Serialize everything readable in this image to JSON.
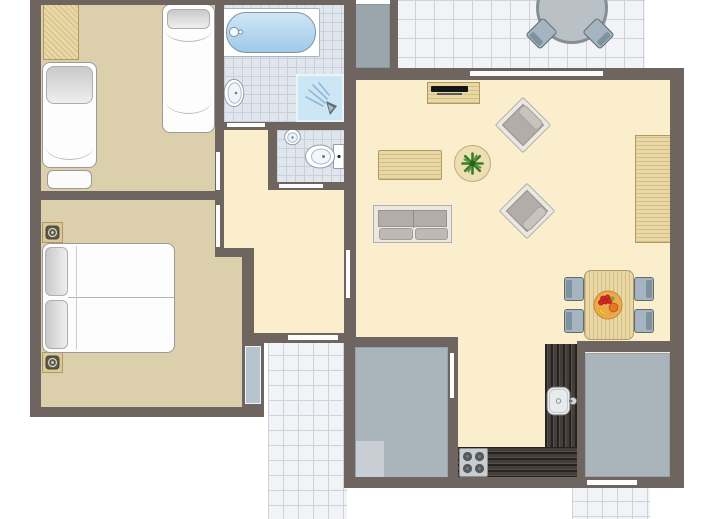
{
  "app": {
    "title": "apartment-floorplan",
    "canvas": {
      "width": 713,
      "height": 519,
      "background": "#ffffff"
    }
  },
  "palette": {
    "wall": "#6e6561",
    "door": "#fdfdfd",
    "floor_cream": "#faeecd",
    "floor_tan": "#dbd0ab",
    "bath_tile": "#e0e6ec",
    "bath_tile_line": "#c6d0dc",
    "path_tile": "#f1f3f6",
    "path_tile_line": "#ccd3db",
    "storage_gray": "#a9b4bb",
    "wood": "#e9d8a6",
    "wood_border": "#b09a62",
    "counter_dark": "#443e3b",
    "upholstery_gray": "#b3aca9",
    "chair_blue": "#a4b5c1",
    "water_blue": "#9fc9e9",
    "plant_green": "#3e7b2b"
  },
  "elements": [
    {
      "name": "terrace-floor",
      "type": "tiles",
      "x": 396,
      "y": 0,
      "w": 249,
      "h": 70,
      "bg": "#f1f3f6",
      "line": "#ccd3db",
      "size": 19
    },
    {
      "name": "entrance-path",
      "type": "tiles",
      "x": 268,
      "y": 340,
      "w": 79,
      "h": 179,
      "bg": "#f1f3f6",
      "line": "#ccd3db",
      "size": 15
    },
    {
      "name": "back-path",
      "type": "tiles",
      "x": 572,
      "y": 486,
      "w": 78,
      "h": 33,
      "bg": "#f1f3f6",
      "line": "#ccd3db",
      "size": 15
    },
    {
      "name": "living-room-floor",
      "type": "rect",
      "x": 356,
      "y": 72,
      "w": 316,
      "h": 408,
      "fill": "#faeecd"
    },
    {
      "name": "hall-floor",
      "type": "rect",
      "x": 224,
      "y": 130,
      "w": 120,
      "h": 210,
      "fill": "#faeecd"
    },
    {
      "name": "bedroom1-floor",
      "type": "rect",
      "x": 41,
      "y": 4,
      "w": 174,
      "h": 187,
      "fill": "#dbd0ab"
    },
    {
      "name": "bedroom2-floor",
      "type": "rect",
      "x": 41,
      "y": 200,
      "w": 174,
      "h": 207,
      "fill": "#dbd0ab"
    },
    {
      "name": "bedroom2-floor-ext",
      "type": "rect",
      "x": 215,
      "y": 252,
      "w": 27,
      "h": 155,
      "fill": "#dbd0ab"
    },
    {
      "name": "bathroom-floor",
      "type": "tiles",
      "x": 215,
      "y": 4,
      "w": 129,
      "h": 126,
      "bg": "#e0e6ec",
      "line": "#c6d0dc",
      "size": 9
    },
    {
      "name": "wc-floor",
      "type": "tiles",
      "x": 277,
      "y": 130,
      "w": 67,
      "h": 60,
      "bg": "#e0e6ec",
      "line": "#c6d0dc",
      "size": 9
    },
    {
      "name": "storage-a-floor",
      "type": "rect",
      "x": 355,
      "y": 347,
      "w": 93,
      "h": 131,
      "fill": "#a9b4bb",
      "border": "1px solid #99a3aa"
    },
    {
      "name": "storage-a-mat",
      "type": "rect",
      "x": 356,
      "y": 441,
      "w": 28,
      "h": 36,
      "fill": "#c7ced4"
    },
    {
      "name": "storage-b-floor",
      "type": "rect",
      "x": 585,
      "y": 353,
      "w": 85,
      "h": 124,
      "fill": "#a9b4bb",
      "border": "1px solid #99a3aa"
    },
    {
      "name": "utility-block",
      "type": "rect",
      "x": 351,
      "y": 4,
      "w": 39,
      "h": 64,
      "fill": "#9aa5ac",
      "border": "1px solid #8a949b"
    },
    {
      "name": "bathtub-surround",
      "type": "rect",
      "x": 222,
      "y": 8,
      "w": 98,
      "h": 49,
      "fill": "#ffffff",
      "border": "1px solid #a9b4bc",
      "radius": "2px"
    },
    {
      "name": "bathtub",
      "type": "rect",
      "x": 226,
      "y": 12,
      "w": 90,
      "h": 41,
      "fill": "linear-gradient(180deg,#cfe6f6,#9fc9e9)",
      "border": "1px solid #7e95a5",
      "radius": "20px"
    },
    {
      "name": "bathtub-faucet-icon",
      "type": "icon",
      "icon": "faucet",
      "x": 228,
      "y": 24,
      "w": 16,
      "h": 16
    },
    {
      "name": "shower-tray",
      "type": "rect",
      "x": 296,
      "y": 74,
      "w": 48,
      "h": 48,
      "fill": "#cde6f5",
      "border": "2px solid #e9f3fa"
    },
    {
      "name": "shower-spray-icon",
      "type": "icon",
      "icon": "spray",
      "x": 302,
      "y": 80,
      "w": 38,
      "h": 38
    },
    {
      "name": "bathroom-sink-icon",
      "type": "icon",
      "icon": "sink-oval",
      "x": 221,
      "y": 76,
      "w": 24,
      "h": 34
    },
    {
      "name": "wc-sink-icon",
      "type": "icon",
      "icon": "sink-round",
      "x": 283,
      "y": 127,
      "w": 19,
      "h": 19
    },
    {
      "name": "toilet-icon",
      "type": "icon",
      "icon": "toilet",
      "x": 304,
      "y": 143,
      "w": 41,
      "h": 27
    },
    {
      "name": "wardrobe",
      "type": "wood",
      "x": 43,
      "y": 4,
      "w": 36,
      "h": 56,
      "angle": 45
    },
    {
      "name": "single-bed-1",
      "type": "rect",
      "x": 162,
      "y": 4,
      "w": 53,
      "h": 129,
      "fill": "#fdfdfd",
      "border": "1px solid #9a9a9a",
      "radius": "8px"
    },
    {
      "name": "single-bed-1-pillow",
      "type": "rect",
      "x": 167,
      "y": 9,
      "w": 43,
      "h": 20,
      "fill": "linear-gradient(180deg,#c9c9c9,#efefef)",
      "border": "1px solid #aeaeae",
      "radius": "6px"
    },
    {
      "name": "single-bed-1-fold-a",
      "type": "arc",
      "x": 165,
      "y": 30,
      "w": 47,
      "h": 12
    },
    {
      "name": "single-bed-1-fold-b",
      "type": "arc",
      "x": 165,
      "y": 100,
      "w": 47,
      "h": 14
    },
    {
      "name": "single-bed-2",
      "type": "rect",
      "x": 42,
      "y": 62,
      "w": 55,
      "h": 106,
      "fill": "#fdfdfd",
      "border": "1px solid #9a9a9a",
      "radius": "8px"
    },
    {
      "name": "single-bed-2-pillow",
      "type": "rect",
      "x": 46,
      "y": 66,
      "w": 47,
      "h": 38,
      "fill": "linear-gradient(180deg,#c9c9c9,#efefef)",
      "border": "1px solid #aeaeae",
      "radius": "8px"
    },
    {
      "name": "single-bed-2-fold",
      "type": "arc",
      "x": 45,
      "y": 146,
      "w": 49,
      "h": 14
    },
    {
      "name": "single-bed-2-footboard",
      "type": "rect",
      "x": 47,
      "y": 170,
      "w": 45,
      "h": 19,
      "fill": "#fbfbfb",
      "border": "1px solid #9a9a9a",
      "radius": "6px"
    },
    {
      "name": "nightstand-a",
      "type": "rect",
      "x": 42,
      "y": 222,
      "w": 21,
      "h": 21,
      "fill": "#dcc998",
      "border": "1px solid #b09a62"
    },
    {
      "name": "lamp-a-icon",
      "type": "icon",
      "icon": "lamp",
      "x": 45,
      "y": 225,
      "w": 15,
      "h": 15
    },
    {
      "name": "nightstand-b",
      "type": "rect",
      "x": 42,
      "y": 352,
      "w": 21,
      "h": 21,
      "fill": "#dcc998",
      "border": "1px solid #b09a62"
    },
    {
      "name": "lamp-b-icon",
      "type": "icon",
      "icon": "lamp",
      "x": 45,
      "y": 355,
      "w": 15,
      "h": 15
    },
    {
      "name": "double-bed",
      "type": "rect",
      "x": 42,
      "y": 243,
      "w": 133,
      "h": 110,
      "fill": "#fdfdfd",
      "border": "1px solid #9a9a9a",
      "radius": "8px"
    },
    {
      "name": "double-bed-pillow-a",
      "type": "rect",
      "x": 45,
      "y": 247,
      "w": 23,
      "h": 49,
      "fill": "linear-gradient(90deg,#c9c9c9,#efefef)",
      "border": "1px solid #aeaeae",
      "radius": "6px"
    },
    {
      "name": "double-bed-pillow-b",
      "type": "rect",
      "x": 45,
      "y": 300,
      "w": 23,
      "h": 49,
      "fill": "linear-gradient(90deg,#c9c9c9,#efefef)",
      "border": "1px solid #aeaeae",
      "radius": "6px"
    },
    {
      "name": "double-bed-split",
      "type": "rect",
      "x": 68,
      "y": 297,
      "w": 106,
      "h": 1,
      "fill": "#b5b5b5"
    },
    {
      "name": "double-bed-fold",
      "type": "rect",
      "x": 76,
      "y": 246,
      "w": 1,
      "h": 104,
      "fill": "#cdcdcd"
    },
    {
      "name": "tv-unit",
      "type": "wood",
      "x": 427,
      "y": 82,
      "w": 53,
      "h": 22,
      "angle": 0
    },
    {
      "name": "tv",
      "type": "rect",
      "x": 431,
      "y": 86,
      "w": 37,
      "h": 6,
      "fill": "#141414",
      "radius": "1px"
    },
    {
      "name": "tv-base",
      "type": "rect",
      "x": 437,
      "y": 93,
      "w": 25,
      "h": 2,
      "fill": "#5a5a5a"
    },
    {
      "name": "coffee-table",
      "type": "wood",
      "x": 378,
      "y": 150,
      "w": 64,
      "h": 30,
      "angle": 0,
      "radius": "2px"
    },
    {
      "name": "side-table",
      "type": "circle",
      "x": 454,
      "y": 145,
      "w": 37,
      "h": 37,
      "fill": "#ecdfb2",
      "border": "1px solid #c3ab76"
    },
    {
      "name": "plant-icon",
      "type": "icon",
      "icon": "plant",
      "x": 461,
      "y": 152,
      "w": 23,
      "h": 23
    },
    {
      "name": "armchair-1",
      "type": "chair",
      "x": 503,
      "y": 105,
      "w": 40,
      "h": 40,
      "rotate": 45,
      "scheme": "warm",
      "bar": "top"
    },
    {
      "name": "armchair-2",
      "type": "chair",
      "x": 507,
      "y": 191,
      "w": 40,
      "h": 40,
      "rotate": 45,
      "scheme": "warm",
      "bar": "right"
    },
    {
      "name": "sofa",
      "type": "sofa",
      "x": 373,
      "y": 205,
      "w": 79,
      "h": 38
    },
    {
      "name": "cabinet",
      "type": "wood",
      "x": 635,
      "y": 135,
      "w": 38,
      "h": 108,
      "angle": 0
    },
    {
      "name": "dining-chair-tl",
      "type": "chair",
      "x": 564,
      "y": 277,
      "w": 20,
      "h": 24,
      "scheme": "cool",
      "bar": "left"
    },
    {
      "name": "dining-chair-bl",
      "type": "chair",
      "x": 564,
      "y": 309,
      "w": 20,
      "h": 24,
      "scheme": "cool",
      "bar": "left"
    },
    {
      "name": "dining-chair-tr",
      "type": "chair",
      "x": 634,
      "y": 277,
      "w": 20,
      "h": 24,
      "scheme": "cool",
      "bar": "right"
    },
    {
      "name": "dining-chair-br",
      "type": "chair",
      "x": 634,
      "y": 309,
      "w": 20,
      "h": 24,
      "scheme": "cool",
      "bar": "right"
    },
    {
      "name": "dining-table",
      "type": "wood",
      "x": 584,
      "y": 270,
      "w": 50,
      "h": 70,
      "angle": 90,
      "radius": "7px"
    },
    {
      "name": "fruit-bowl-icon",
      "type": "icon",
      "icon": "fruit",
      "x": 593,
      "y": 290,
      "w": 30,
      "h": 30
    },
    {
      "name": "kitchen-counter-main",
      "type": "counter",
      "x": 545,
      "y": 344,
      "w": 33,
      "h": 134,
      "angle": 90
    },
    {
      "name": "kitchen-counter-side",
      "type": "counter",
      "x": 457,
      "y": 447,
      "w": 121,
      "h": 31,
      "angle": 0
    },
    {
      "name": "stove",
      "type": "rect",
      "x": 459,
      "y": 448,
      "w": 29,
      "h": 29,
      "fill": "#c9cdd0",
      "border": "1px solid #8a9094",
      "radius": "2px"
    },
    {
      "name": "stove-burners-icon",
      "type": "icon",
      "icon": "burners",
      "x": 459,
      "y": 448,
      "w": 29,
      "h": 29
    },
    {
      "name": "kitchen-sink-icon",
      "type": "icon",
      "icon": "ksink",
      "x": 546,
      "y": 384,
      "w": 31,
      "h": 34
    },
    {
      "name": "terrace-table",
      "type": "circle",
      "x": 536,
      "y": -28,
      "w": 72,
      "h": 72,
      "fill": "#b9c1c7",
      "border": "3px solid #878f96"
    },
    {
      "name": "terrace-chair-a",
      "type": "chair",
      "x": 531,
      "y": 21,
      "w": 21,
      "h": 25,
      "rotate": 45,
      "scheme": "cool",
      "bar": "bottom"
    },
    {
      "name": "terrace-chair-b",
      "type": "chair",
      "x": 588,
      "y": 21,
      "w": 21,
      "h": 25,
      "rotate": -45,
      "scheme": "cool",
      "bar": "bottom"
    },
    {
      "name": "wall-top",
      "type": "rect",
      "x": 30,
      "y": 0,
      "w": 326,
      "h": 5,
      "fill": "#6e6561"
    },
    {
      "name": "wall-left",
      "type": "rect",
      "x": 30,
      "y": 0,
      "w": 11,
      "h": 417,
      "fill": "#6e6561"
    },
    {
      "name": "wall-bedrooms-divider",
      "type": "rect",
      "x": 30,
      "y": 191,
      "w": 194,
      "h": 9,
      "fill": "#6e6561"
    },
    {
      "name": "wall-bedroom-right",
      "type": "rect",
      "x": 215,
      "y": 0,
      "w": 9,
      "h": 257,
      "fill": "#6e6561"
    },
    {
      "name": "wall-hall-jog",
      "type": "rect",
      "x": 215,
      "y": 248,
      "w": 39,
      "h": 9,
      "fill": "#6e6561"
    },
    {
      "name": "wall-bedroom2-right",
      "type": "rect",
      "x": 242,
      "y": 248,
      "w": 12,
      "h": 95,
      "fill": "#6e6561"
    },
    {
      "name": "wall-bedroom2-right-low",
      "type": "rect",
      "x": 242,
      "y": 343,
      "w": 22,
      "h": 74,
      "fill": "#6e6561"
    },
    {
      "name": "wall-bedroom2-bottom",
      "type": "rect",
      "x": 30,
      "y": 407,
      "w": 234,
      "h": 10,
      "fill": "#6e6561"
    },
    {
      "name": "wall-bathroom-bottom",
      "type": "rect",
      "x": 215,
      "y": 122,
      "w": 129,
      "h": 8,
      "fill": "#6e6561"
    },
    {
      "name": "wall-wc-left",
      "type": "rect",
      "x": 268,
      "y": 130,
      "w": 9,
      "h": 60,
      "fill": "#6e6561"
    },
    {
      "name": "wall-wc-bottom",
      "type": "rect",
      "x": 268,
      "y": 182,
      "w": 76,
      "h": 8,
      "fill": "#6e6561"
    },
    {
      "name": "wall-central",
      "type": "rect",
      "x": 344,
      "y": 0,
      "w": 12,
      "h": 343,
      "fill": "#6e6561"
    },
    {
      "name": "wall-living-top",
      "type": "rect",
      "x": 344,
      "y": 68,
      "w": 338,
      "h": 12,
      "fill": "#6e6561"
    },
    {
      "name": "wall-terrace-left",
      "type": "rect",
      "x": 390,
      "y": 0,
      "w": 8,
      "h": 68,
      "fill": "#6e6561"
    },
    {
      "name": "wall-right",
      "type": "rect",
      "x": 670,
      "y": 68,
      "w": 14,
      "h": 420,
      "fill": "#6e6561"
    },
    {
      "name": "wall-bottom",
      "type": "rect",
      "x": 344,
      "y": 477,
      "w": 340,
      "h": 11,
      "fill": "#6e6561"
    },
    {
      "name": "wall-storage-a-top",
      "type": "rect",
      "x": 344,
      "y": 337,
      "w": 114,
      "h": 10,
      "fill": "#6e6561"
    },
    {
      "name": "wall-storage-a-left",
      "type": "rect",
      "x": 344,
      "y": 343,
      "w": 11,
      "h": 145,
      "fill": "#6e6561"
    },
    {
      "name": "wall-storage-a-right",
      "type": "rect",
      "x": 448,
      "y": 337,
      "w": 10,
      "h": 141,
      "fill": "#6e6561"
    },
    {
      "name": "wall-storage-b-top",
      "type": "rect",
      "x": 577,
      "y": 341,
      "w": 107,
      "h": 11,
      "fill": "#6e6561"
    },
    {
      "name": "wall-storage-b-left",
      "type": "rect",
      "x": 577,
      "y": 341,
      "w": 8,
      "h": 137,
      "fill": "#6e6561"
    },
    {
      "name": "wall-front",
      "type": "rect",
      "x": 242,
      "y": 333,
      "w": 114,
      "h": 10,
      "fill": "#6e6561"
    },
    {
      "name": "door-bathroom",
      "type": "rect",
      "x": 227,
      "y": 123,
      "w": 38,
      "h": 4,
      "fill": "#fdfdfd"
    },
    {
      "name": "door-wc",
      "type": "rect",
      "x": 279,
      "y": 184,
      "w": 44,
      "h": 4,
      "fill": "#fdfdfd"
    },
    {
      "name": "door-bedroom1",
      "type": "rect",
      "x": 216,
      "y": 152,
      "w": 4,
      "h": 38,
      "fill": "#fdfdfd"
    },
    {
      "name": "door-bedroom2",
      "type": "rect",
      "x": 216,
      "y": 205,
      "w": 4,
      "h": 42,
      "fill": "#fdfdfd"
    },
    {
      "name": "door-living",
      "type": "rect",
      "x": 346,
      "y": 250,
      "w": 4,
      "h": 48,
      "fill": "#fdfdfd"
    },
    {
      "name": "door-terrace",
      "type": "rect",
      "x": 470,
      "y": 71,
      "w": 133,
      "h": 5,
      "fill": "#fdfdfd"
    },
    {
      "name": "door-front",
      "type": "rect",
      "x": 288,
      "y": 335,
      "w": 50,
      "h": 5,
      "fill": "#fdfdfd"
    },
    {
      "name": "door-back",
      "type": "rect",
      "x": 587,
      "y": 480,
      "w": 50,
      "h": 5,
      "fill": "#fdfdfd"
    },
    {
      "name": "door-storage-a",
      "type": "rect",
      "x": 450,
      "y": 353,
      "w": 4,
      "h": 45,
      "fill": "#fdfdfd"
    },
    {
      "name": "window-bedroom2",
      "type": "rect",
      "x": 245,
      "y": 346,
      "w": 16,
      "h": 58,
      "fill": "#b6c4ce",
      "border": "1px solid #eef2f5"
    }
  ]
}
